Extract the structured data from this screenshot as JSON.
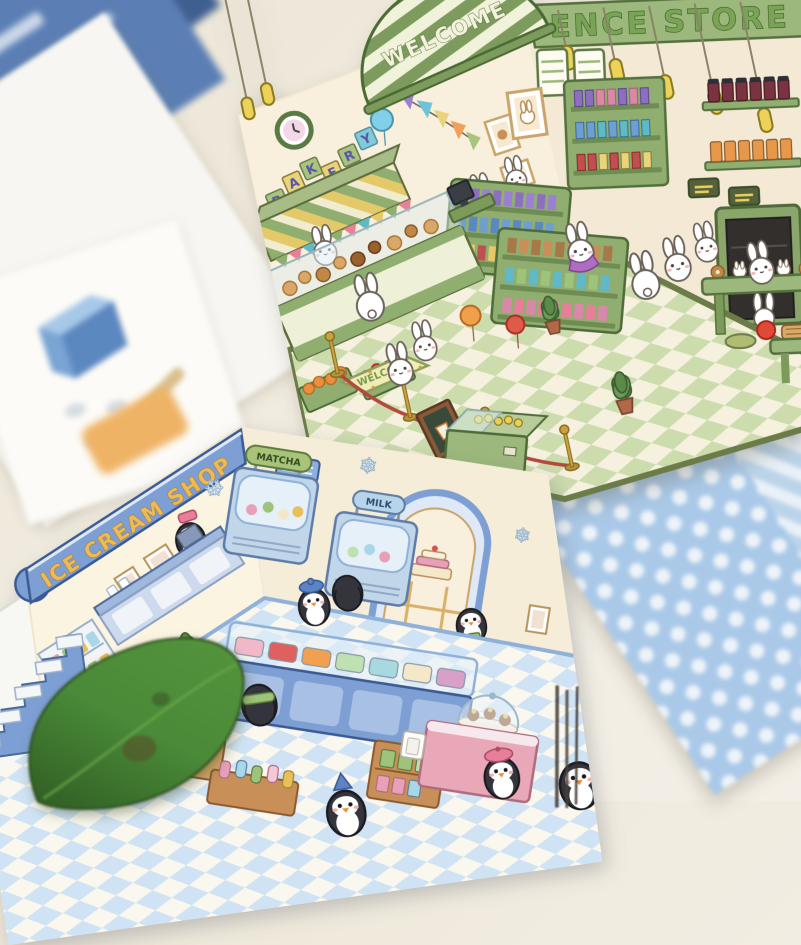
{
  "photo": {
    "description": "Two die-cut isometric cardboard scene cards on a table: a green bunny convenience store with bakery, and a blue penguin ice cream shop, surrounded by blurred papers, a polka-dot card back and a green leaf.",
    "colors": {
      "table_surface": "#efe9dc",
      "blue_paper": "#5b7fb5",
      "white_paper": "#f7f6f2",
      "dot_card": "#aac9e8",
      "dot_card_panel": "#e9d9c3",
      "leaf": "#3e7430"
    }
  },
  "convenience_store": {
    "store_sign_text": "ENCE STORE",
    "awning_text": "WELCOME",
    "bakery_letters": [
      "B",
      "A",
      "K",
      "E",
      "R",
      "Y"
    ],
    "floor_mat_text": "WELCOME",
    "colors": {
      "wall": "#f9efdd",
      "sign_band": "#9db87c",
      "sign_letters": "#6f9c4a",
      "floor_light": "#f5f1de",
      "floor_green": "#ccdcad",
      "counter": "#8fae6f",
      "awning_stripe": "#7d9b5d",
      "pendant": "#ecd258",
      "rope": "#b5483c"
    }
  },
  "ice_cream_shop": {
    "shop_sign_text": "ICE CREAM SHOP",
    "freezer_sign_left": "MATCHA",
    "freezer_sign_right": "MILK",
    "colors": {
      "wall": "#fbf4e1",
      "sign_band": "#7d9fd4",
      "sign_letters": "#edba55",
      "floor_light": "#f9f7ee",
      "floor_blue": "#cfe3f4",
      "counter": "#7d9fd4",
      "matcha": "#a8c47a",
      "milk": "#b8d4ea",
      "pink": "#e8a8b8",
      "wood": "#d9a968"
    }
  },
  "icons": {
    "snowflake": "❄"
  }
}
